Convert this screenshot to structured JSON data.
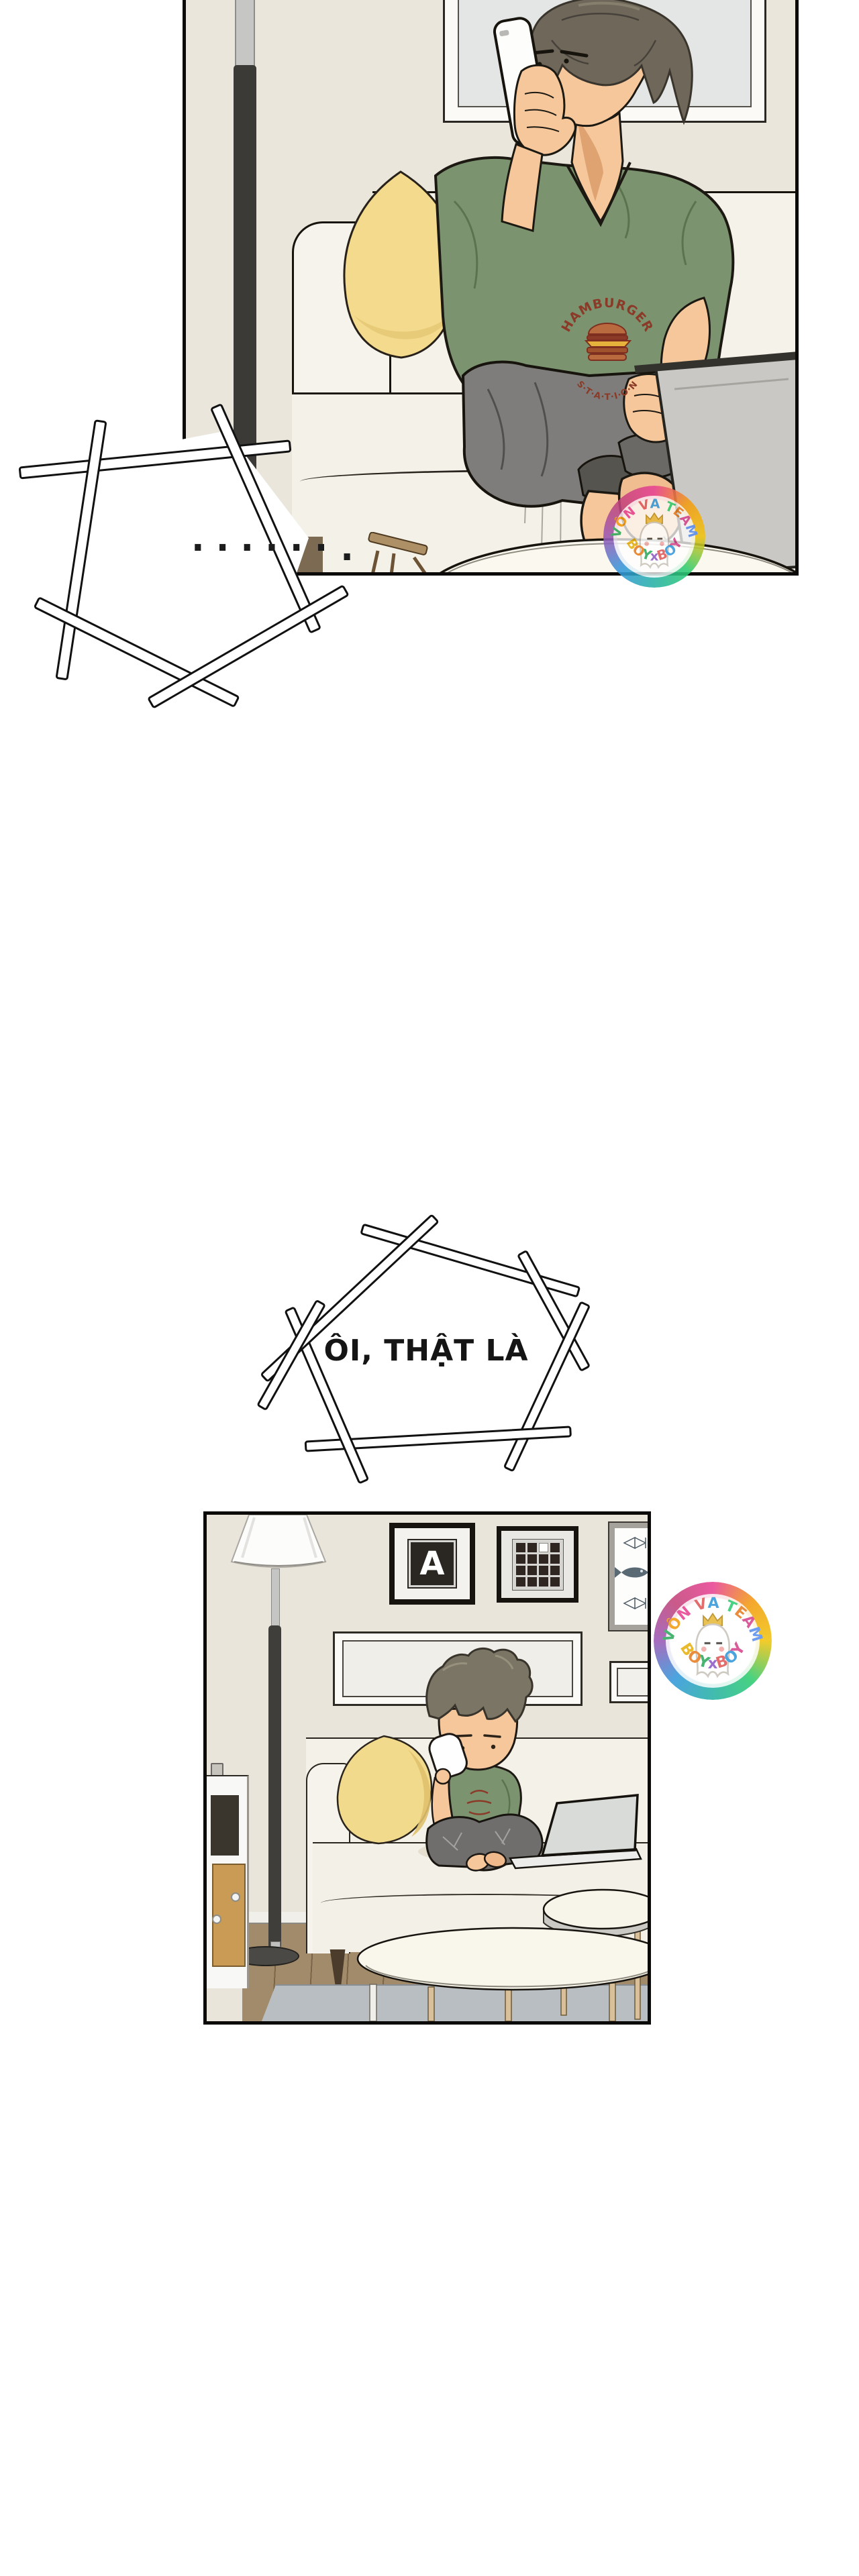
{
  "page_bg": "#ffffff",
  "panel1": {
    "label": "man sitting cross-legged on a cream sofa talking on a white phone",
    "shirt_logo_top": "HAMBURGER",
    "shirt_logo_bottom": "S·T·A·T·I·O·N"
  },
  "bubble1": {
    "dots": "......",
    "tail_dot": "."
  },
  "bubble2": {
    "text": "ÔI, THẬT LÀ"
  },
  "panel2": {
    "label": "chibi man on phone sitting on sofa with laptop",
    "poster_letter": "A"
  },
  "watermark": {
    "arc_top": "VÔN VA TEAM",
    "arc_bottom": "BOYxBOY",
    "top_colors": [
      "#2eaa5e",
      "#f39c12",
      "#e84393",
      "#8e5cc6",
      "#e05a5a",
      "#3498db",
      "#d49b0c",
      "#2ecc71",
      "#e67e22",
      "#d6458c",
      "#5b8ff0"
    ],
    "bottom_colors": [
      "#e6b10f",
      "#e67e22",
      "#2eaa5e",
      "#8e5cc6",
      "#e05a5a",
      "#3498db",
      "#d6458c"
    ]
  },
  "colors": {
    "wall": "#eae6dc",
    "sofa": "#f5f2e9",
    "pillow": "#f3da8c",
    "skin": "#f5c79b",
    "hair": "#6e675a",
    "shirt_green": "#7c9370",
    "pants_gray": "#7e7d7b",
    "logo_red": "#8a3a27",
    "floor_wood": "#a28b6b",
    "rug": "#b9bec2",
    "lamp_dark": "#3b3a36",
    "outline": "#17130d"
  }
}
